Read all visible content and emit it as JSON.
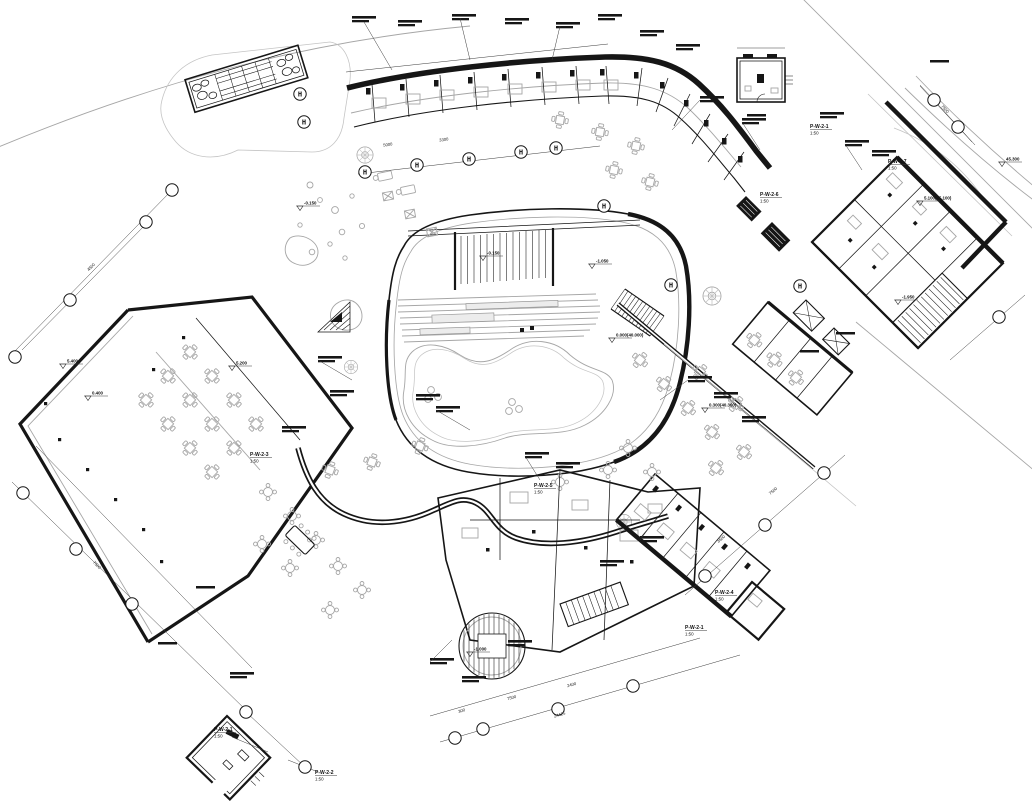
{
  "drawing": {
    "type": "architectural-floor-plan",
    "palette": {
      "paper": "#ffffff",
      "ink": "#161616",
      "light": "#a6a6a6"
    },
    "grid_bubbles": [
      {
        "x": 300,
        "y": 94,
        "label": "H"
      },
      {
        "x": 304,
        "y": 122,
        "label": "H"
      },
      {
        "x": 365,
        "y": 172,
        "label": "H"
      },
      {
        "x": 417,
        "y": 165,
        "label": "H"
      },
      {
        "x": 469,
        "y": 159,
        "label": "H"
      },
      {
        "x": 521,
        "y": 152,
        "label": "H"
      },
      {
        "x": 556,
        "y": 148,
        "label": "H"
      },
      {
        "x": 604,
        "y": 206,
        "label": "H"
      },
      {
        "x": 671,
        "y": 285,
        "label": "H"
      },
      {
        "x": 800,
        "y": 286,
        "label": "H"
      },
      {
        "x": 172,
        "y": 190,
        "label": ""
      },
      {
        "x": 146,
        "y": 222,
        "label": ""
      },
      {
        "x": 70,
        "y": 300,
        "label": ""
      },
      {
        "x": 15,
        "y": 357,
        "label": ""
      },
      {
        "x": 23,
        "y": 493,
        "label": ""
      },
      {
        "x": 76,
        "y": 549,
        "label": ""
      },
      {
        "x": 132,
        "y": 604,
        "label": ""
      },
      {
        "x": 246,
        "y": 712,
        "label": ""
      },
      {
        "x": 305,
        "y": 767,
        "label": ""
      },
      {
        "x": 455,
        "y": 738,
        "label": ""
      },
      {
        "x": 483,
        "y": 729,
        "label": ""
      },
      {
        "x": 558,
        "y": 709,
        "label": ""
      },
      {
        "x": 633,
        "y": 686,
        "label": ""
      },
      {
        "x": 705,
        "y": 576,
        "label": ""
      },
      {
        "x": 765,
        "y": 525,
        "label": ""
      },
      {
        "x": 824,
        "y": 473,
        "label": ""
      },
      {
        "x": 934,
        "y": 100,
        "label": ""
      },
      {
        "x": 958,
        "y": 127,
        "label": ""
      },
      {
        "x": 999,
        "y": 317,
        "label": ""
      }
    ],
    "elevation_markers": [
      {
        "x": 300,
        "y": 206,
        "text": "-0.150"
      },
      {
        "x": 483,
        "y": 256,
        "text": "-0.150"
      },
      {
        "x": 592,
        "y": 264,
        "text": "-1.050"
      },
      {
        "x": 63,
        "y": 364,
        "text": "5.400"
      },
      {
        "x": 88,
        "y": 396,
        "text": "0.400"
      },
      {
        "x": 232,
        "y": 366,
        "text": "5.200"
      },
      {
        "x": 470,
        "y": 652,
        "text": "-1.000"
      },
      {
        "x": 898,
        "y": 300,
        "text": "-1.950"
      },
      {
        "x": 920,
        "y": 201,
        "text": "5.100(45.100)"
      },
      {
        "x": 705,
        "y": 408,
        "text": "0.300(40.300)"
      },
      {
        "x": 1002,
        "y": 162,
        "text": "45.300"
      },
      {
        "x": 612,
        "y": 338,
        "text": "0.000(40.000)"
      }
    ],
    "detail_codes": [
      {
        "x": 810,
        "y": 128,
        "code": "P-W-2-1",
        "scale": "1:50"
      },
      {
        "x": 760,
        "y": 196,
        "code": "P-W-2-6",
        "scale": "1:50"
      },
      {
        "x": 888,
        "y": 163,
        "code": "P-W-2-7",
        "scale": "1:50"
      },
      {
        "x": 250,
        "y": 456,
        "code": "P-W-2-3",
        "scale": "1:50"
      },
      {
        "x": 715,
        "y": 594,
        "code": "P-W-2-4",
        "scale": "1:50"
      },
      {
        "x": 685,
        "y": 629,
        "code": "P-W-2-1",
        "scale": "1:50"
      },
      {
        "x": 214,
        "y": 731,
        "code": "P-W-2-1",
        "scale": "1:50"
      },
      {
        "x": 315,
        "y": 774,
        "code": "P-W-2-2",
        "scale": "1:50"
      },
      {
        "x": 534,
        "y": 487,
        "code": "P-W-2-5",
        "scale": "1:50"
      }
    ],
    "dimensions": [
      {
        "x": 388,
        "y": 146,
        "rot": -8,
        "text": "5000"
      },
      {
        "x": 444,
        "y": 141,
        "rot": -8,
        "text": "3300"
      },
      {
        "x": 462,
        "y": 712,
        "rot": -16,
        "text": "300"
      },
      {
        "x": 512,
        "y": 699,
        "rot": -16,
        "text": "7500"
      },
      {
        "x": 572,
        "y": 686,
        "rot": -16,
        "text": "2400"
      },
      {
        "x": 560,
        "y": 716,
        "rot": -16,
        "text": "24425"
      },
      {
        "x": 722,
        "y": 540,
        "rot": -40,
        "text": "3600"
      },
      {
        "x": 774,
        "y": 492,
        "rot": -40,
        "text": "7500"
      },
      {
        "x": 96,
        "y": 566,
        "rot": 46,
        "text": "7500"
      },
      {
        "x": 92,
        "y": 268,
        "rot": -45,
        "text": "4500"
      },
      {
        "x": 944,
        "y": 110,
        "rot": 47,
        "text": "7500"
      }
    ]
  }
}
